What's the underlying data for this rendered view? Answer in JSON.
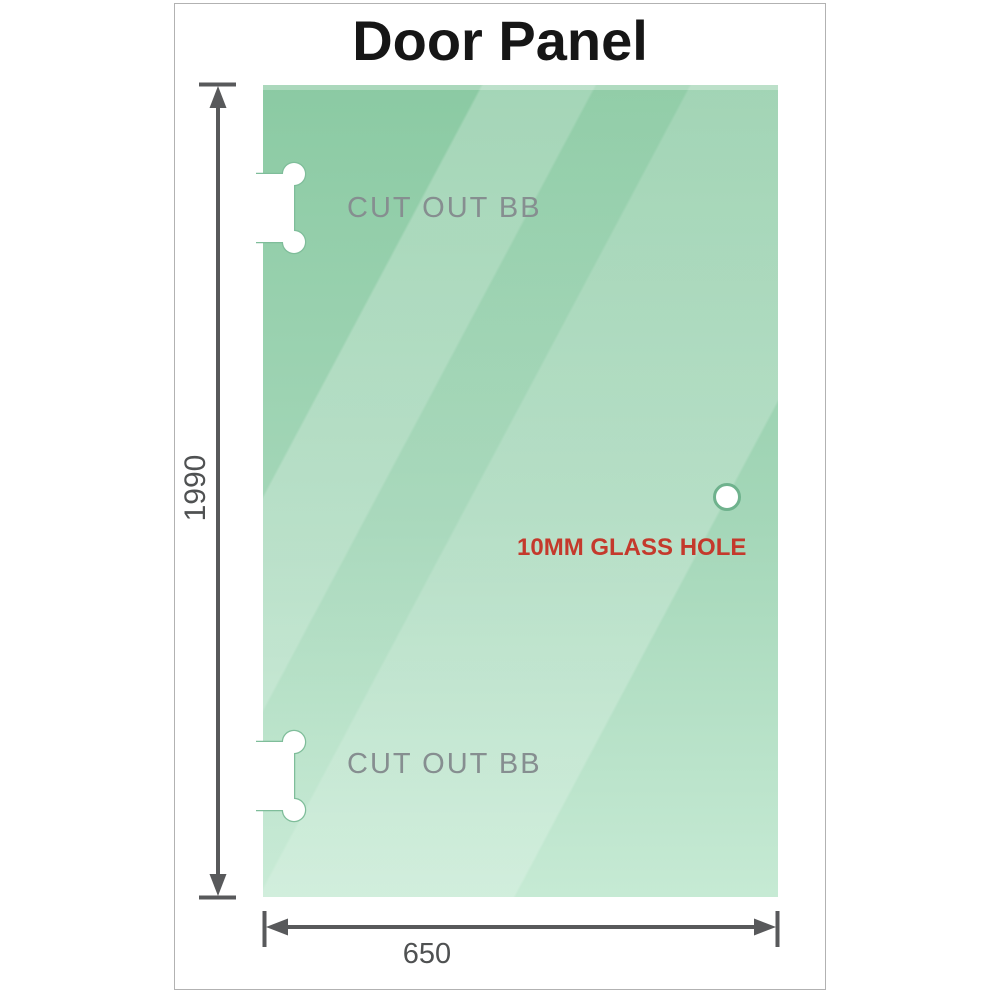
{
  "diagram": {
    "title": "Door Panel",
    "height_dimension": "1990",
    "width_dimension": "650",
    "cutout_top": {
      "label": "CUT OUT BB"
    },
    "cutout_bottom": {
      "label": "CUT OUT BB"
    },
    "glass_hole": {
      "label": "10MM GLASS HOLE"
    },
    "colors": {
      "glass_gradient_top": "#8bcaa3",
      "glass_gradient_bottom": "#c6ead4",
      "cutout_outline_green": "#7fbd9a",
      "dimension_line_gray": "#58595b",
      "cutout_label_gray": "#868e90",
      "dimension_text_gray": "#4f5152",
      "glass_hole_label_red": "#c4392c",
      "card_border_gray": "#b2b2b2",
      "title_black": "#161616"
    }
  }
}
